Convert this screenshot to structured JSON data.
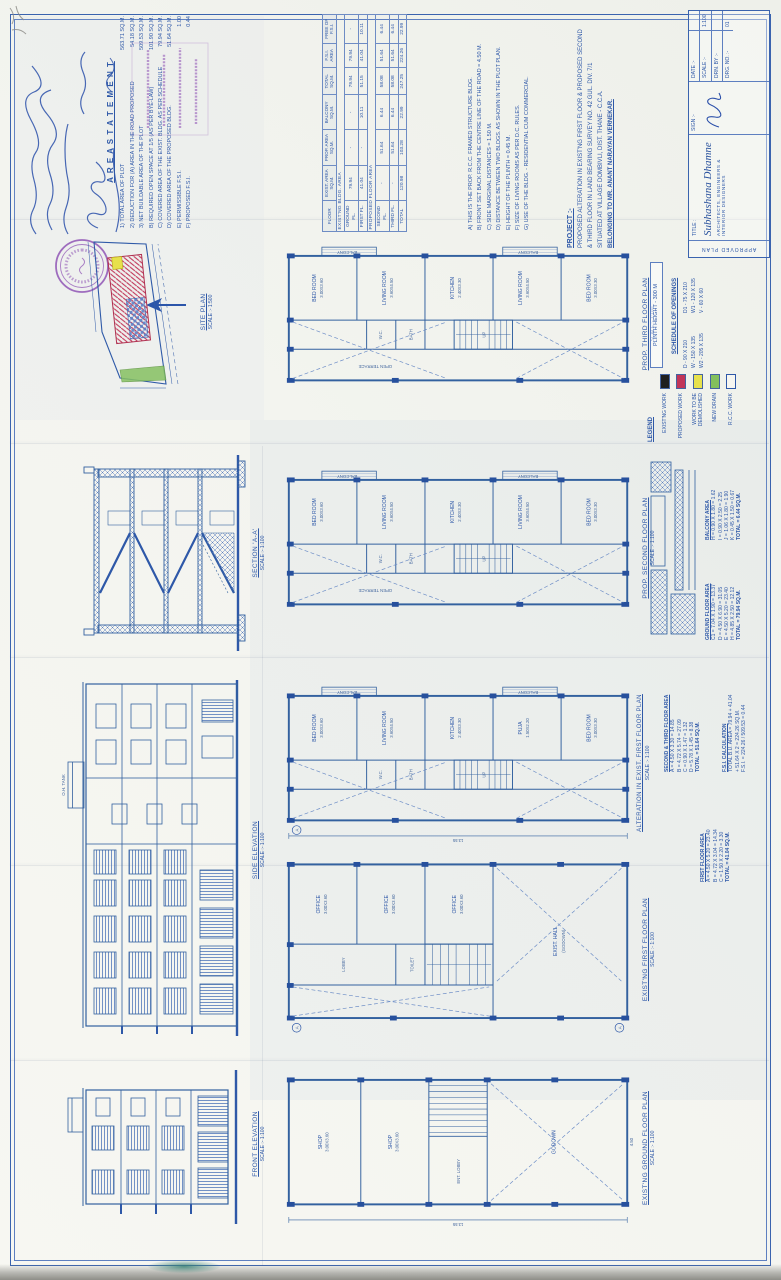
{
  "area_statement": {
    "heading": "A R E A   S T A T E M E N T",
    "items": [
      {
        "label": "1) TOTAL AREA OF PLOT",
        "value": "563.71 SQ.M."
      },
      {
        "label": "2) DEDUCTION FOR (A) AREA IN THE ROAD PROPOSED",
        "value": "54.18 SQ.M."
      },
      {
        "label": "3) NET BUILDABLE AREA OF THE PLOT",
        "value": "509.53 SQ.M."
      },
      {
        "label": "B) REQUIRED OPEN SPACE AT 1/5 (AS PER BYE-LAW)",
        "value": "101.90 SQ.M."
      },
      {
        "label": "C) COVERED AREA OF THE EXIST. BLDG. AS PER SCHEDULE",
        "value": "79.94 SQ.M."
      },
      {
        "label": "D) COVERED AREA OF THE PROPOSED BLDG.",
        "value": "51.64 SQ.M."
      },
      {
        "label": "E) PERMISSIBLE F.S.I.",
        "value": "1.00"
      },
      {
        "label": "F) PROPOSED F.S.I.",
        "value": "0.44"
      }
    ]
  },
  "area_table": {
    "headers": [
      "FLOOR",
      "EXIST. AREA SQ.M.",
      "PROP. AREA SQ.M.",
      "BALCONY SQ.M.",
      "TOTAL SQ.M.",
      "F.S.I. AREA",
      "FREE OF F.S.I."
    ],
    "group1": "EXIST'NG BLDG. AREA",
    "group2": "PROPOSED FLOOR AREA",
    "rows1": [
      [
        "GROUND FL.",
        "79.94",
        "-",
        "-",
        "79.94",
        "79.94",
        "-"
      ],
      [
        "FIRST FL.",
        "41.04",
        "-",
        "10.11",
        "51.15",
        "41.04",
        "10.11"
      ]
    ],
    "rows2": [
      [
        "SECOND FL.",
        "-",
        "51.64",
        "6.44",
        "58.08",
        "51.64",
        "6.44"
      ],
      [
        "THIRD FL.",
        "-",
        "51.64",
        "6.44",
        "58.08",
        "51.64",
        "6.44"
      ]
    ],
    "total": [
      "TOTAL",
      "120.98",
      "103.28",
      "22.99",
      "247.25",
      "224.26",
      "22.99"
    ]
  },
  "notes": {
    "lines": [
      "A) THIS IS THE PROP. R.C.C. FRAMED STRUCTURE BLDG.",
      "B) FRONT SET BACK FROM THE CENTRE LINE OF THE ROAD = 4.50 M.",
      "C) SIDE MARGINAL DISTANCES = 1.50 M.",
      "D) DISTANCE BETWEEN TWO BLDGS. AS SHOWN IN THE PLOT PLAN.",
      "E) HEIGHT OF THE PLINTH = 0.45 M.",
      "F) SIZE OF LIVING ROOMS AS PER D.C. RULES.",
      "G) USE OF THE BLDG. - RESIDENTIAL CUM COMMERCIAL."
    ]
  },
  "project": {
    "heading": "PROJECT :-",
    "lines": [
      "PROPOSED ALTERATION IN EXIST'NG FIRST FLOOR & PROPOSED SECOND",
      "& THIRD FLOOR IN LAND BEARING SURVEY NO. 42 GUL. DIV. 7/1",
      "SITUATED AT VILLAGE DOMBIVLI, DIST. THANE - C.C.A."
    ],
    "owner_line": "BELONGING TO MR. ANANT NARAYAN VERNEKAR."
  },
  "title_block": {
    "approved_label": "APPROVED PLAN",
    "title_label": "TITLE :",
    "firm_name": "Subhashana Dhamne",
    "firm_subtitle": "ARCHITECTS, ENGINEERS & INTERIOR DESIGNERS",
    "sign_label": "SIGN :-",
    "fields": [
      {
        "label": "DATE :-",
        "value": ""
      },
      {
        "label": "SCALE :-",
        "value": "1:100"
      },
      {
        "label": "DRN. BY :-",
        "value": ""
      },
      {
        "label": "DRG. NO. :-",
        "value": "01"
      }
    ]
  },
  "plans": {
    "flat_rooms": [
      [
        "BED ROOM",
        "3.00X3.60"
      ],
      [
        "LIVING ROOM",
        "3.60X4.50"
      ],
      [
        "KITCHEN",
        "2.40X3.30"
      ],
      [
        "LIVING ROOM",
        "3.60X4.50"
      ],
      [
        "BED ROOM",
        "3.00X3.30"
      ]
    ],
    "cells": {
      "wc": "W.C.",
      "bath": "BATH",
      "up": "UP",
      "balcony": "BALCONY",
      "terrace": "OPEN TERRACE"
    },
    "p1": {
      "title": "PROP. THIRD FLOOR PLAN",
      "scale": "SCALE :- 1:100"
    },
    "p2": {
      "title": "PROP. SECOND FLOOR PLAN",
      "scale": "SCALE :- 1:100"
    },
    "p3": {
      "title": "ALTERATION IN EXIST. FIRST FLOOR PLAN",
      "scale": "SCALE :- 1:100",
      "rooms": [
        [
          "BED ROOM",
          "3.00X3.60"
        ],
        [
          "LIVING ROOM",
          "3.60X4.50"
        ],
        [
          "KITCHEN",
          "2.40X3.30"
        ],
        [
          "PUJA",
          "1.50X2.20"
        ],
        [
          "BED ROOM",
          "3.00X3.30"
        ]
      ]
    },
    "p4": {
      "title": "EXIST'NG FIRST FLOOR PLAN",
      "scale": "SCALE :- 1:100",
      "rooms": [
        [
          "OFFICE",
          "3.00X3.60"
        ],
        [
          "OFFICE",
          "3.00X3.60"
        ],
        [
          "OFFICE",
          "3.00X3.60"
        ]
      ],
      "lobby": "LOBBY",
      "toilet": "TOILET",
      "hall": [
        "EXIST. HALL",
        "(GODOWN)"
      ]
    },
    "p5": {
      "title": "EXIST'NG GROUND FLOOR PLAN",
      "scale": "SCALE :- 1:100",
      "rooms": [
        [
          "SHOP",
          "3.00X3.60"
        ],
        [
          "SHOP",
          "3.00X3.60"
        ]
      ],
      "ent": "ENT. LOBBY",
      "godown": "GODOWN"
    },
    "marker": "A",
    "dims": {
      "length": "13.55",
      "width": "4.50"
    }
  },
  "elevations": {
    "front": {
      "label": "FRONT ELEVATION",
      "scale": "SCALE :- 1:100"
    },
    "side": {
      "label": "SIDE ELEVATION",
      "scale": "SCALE :- 1:100"
    },
    "section": {
      "label": "SECTION 'A-A'",
      "scale": "SCALE :- 1:100"
    },
    "tank": "O.H. TANK"
  },
  "site": {
    "label": "SITE PLAN",
    "scale": "SCALE :- 1:500"
  },
  "plinth_note": "PLINTH HEIGHT - 300 M",
  "schedule": {
    "heading": "SCHEDULE OF OPENINGS",
    "entries_left": [
      "D - 90 X 210",
      "W - 150 X 135",
      "W2 - 205 X 135"
    ],
    "entries_right": [
      "D1 - 75 X 210",
      "W1 - 120 X 135",
      "V - 60 X 60"
    ]
  },
  "legend": {
    "heading": "LEGEND",
    "items": [
      {
        "label": "EXIST'NG WORK",
        "color": "#1f1f1f",
        "sw": "background:#1f1f1f"
      },
      {
        "label": "PROPOSED WORK",
        "color": "#c13558",
        "sw": "background:#c13558"
      },
      {
        "label": "WORK TO BE DEMOLISHED",
        "color": "#e7e14c",
        "sw": "background:#e7e14c"
      },
      {
        "label": "NEW DRAIN",
        "color": "#83c05c",
        "sw": "background:#83c05c"
      },
      {
        "label": "R.C.C. WORK",
        "color": "#f6f6f1",
        "sw": "background:#f6f6f1;border:1px solid #2e58a8"
      }
    ]
  },
  "calcs": {
    "second": {
      "heading": "SECOND & THIRD FLOOR AREA",
      "lines": [
        "A = 4.50 X 3.30 = 14.85",
        "B = 4.72 X 5.74 = 27.09",
        "C = 0.90 X 1.47 = 1.32",
        "D = 5.78 X 1.45 = 8.38",
        "TOTAL = 51.64 SQ.M."
      ]
    },
    "balcony": {
      "heading": "BALCONY AREA",
      "lines": [
        "H = 0.90 X 1.80 = 1.62",
        "I = 0.90 X 2.50 = 2.25",
        "J = 1.06 X 1.80 = 1.90",
        "K = 0.45 X 1.50 = 0.67",
        "TOTAL = 6.44 SQ.M."
      ]
    },
    "ground": {
      "heading": "GROUND FLOOR AREA",
      "lines": [
        "C1 = 7.04 X 1.90 = 13.37",
        "D = 4.50 X 6.90 = 31.05",
        "E = 4.50 X 5.20 = 23.40",
        "H = 4.85 X 2.50 = 12.12",
        "TOTAL = 79.94 SQ.M."
      ]
    },
    "first": {
      "heading": "FIRST FLOOR AREA",
      "lines": [
        "A = 4.50 X 5.20 = 23.40",
        "B = 4.72 X 3.04 = 14.34",
        "C = 1.50 X 2.20 = 3.30",
        "TOTAL = 41.04 SQ.M."
      ]
    },
    "fsi": {
      "heading": "F.S.I. CALCULATION",
      "lines": [
        "TOTAL B.U. AREA = 79.94 + 41.04",
        "+ 51.64 X 2 = 224.26 SQ.M.",
        "F.S.I. = 224.26 / 509.53 = 0.44"
      ]
    }
  }
}
